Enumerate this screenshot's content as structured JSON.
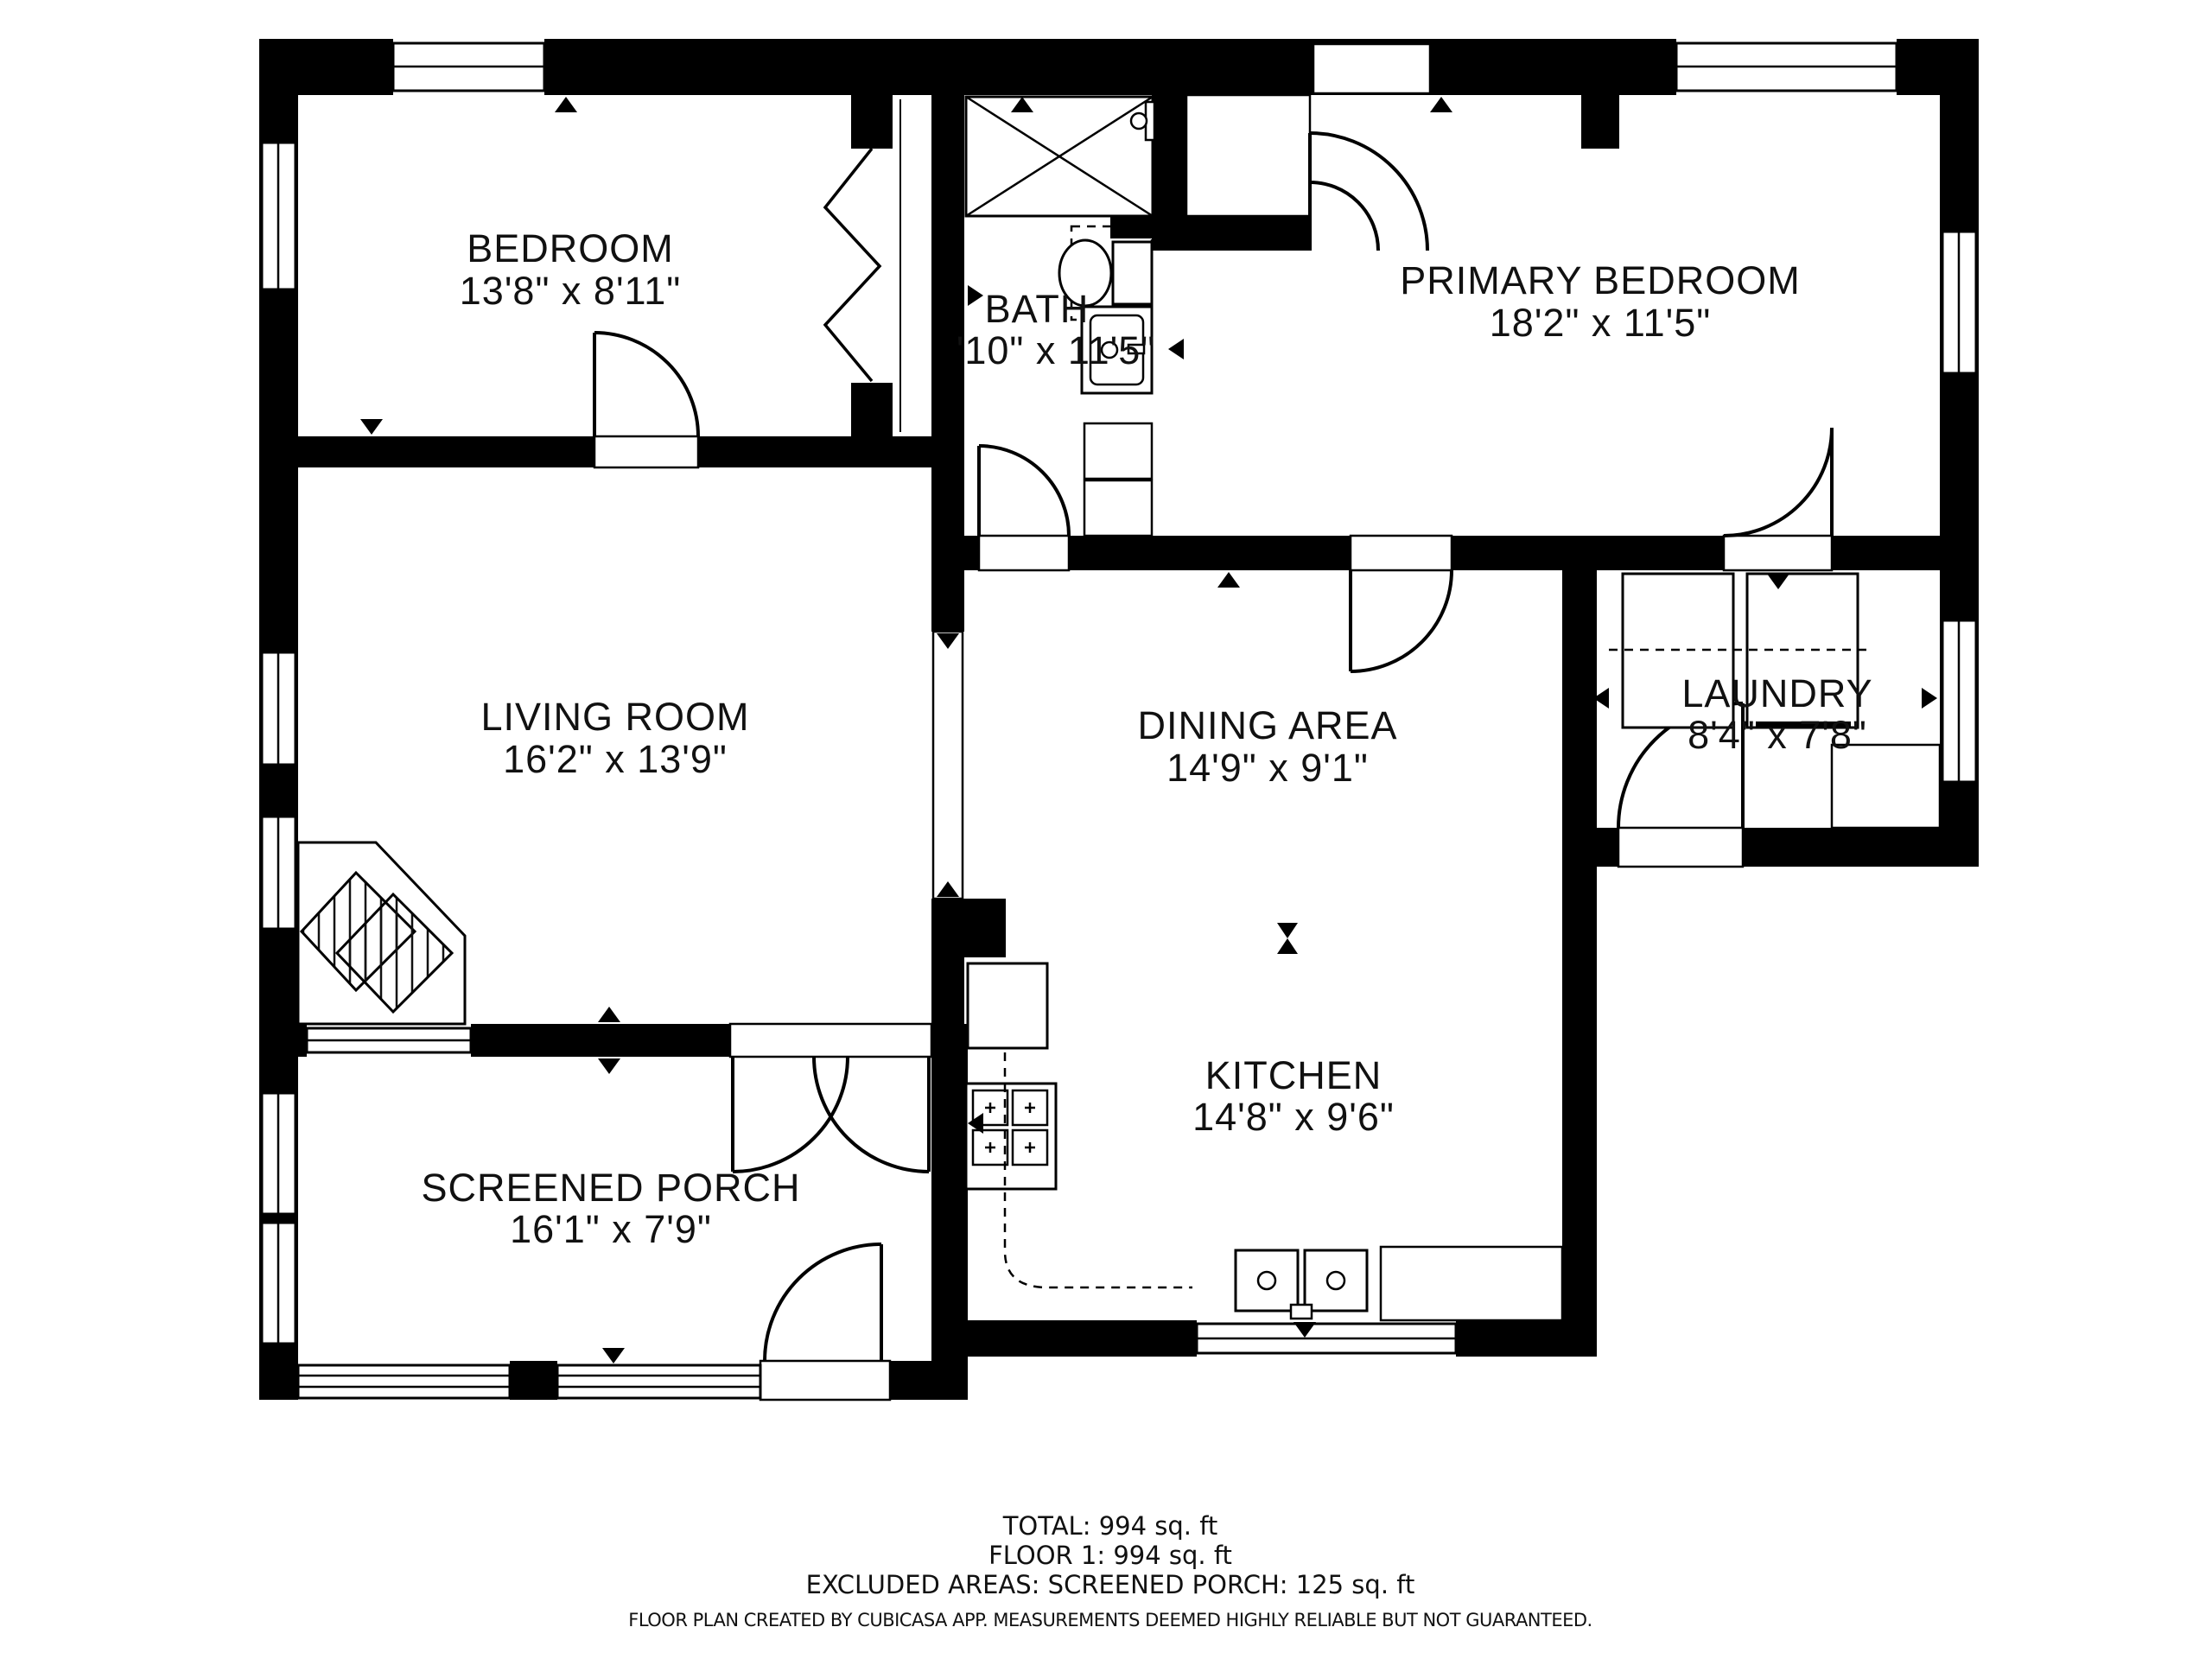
{
  "plan": {
    "wall_color": "#000000",
    "background": "#ffffff",
    "rooms": [
      {
        "id": "bedroom",
        "name": "BEDROOM",
        "dims": "13'8\" x 8'11\""
      },
      {
        "id": "bath",
        "name": "BATH",
        "dims": "'10\" x 11'5\""
      },
      {
        "id": "primary-bedroom",
        "name": "PRIMARY BEDROOM",
        "dims": "18'2\" x 11'5\""
      },
      {
        "id": "living-room",
        "name": "LIVING ROOM",
        "dims": "16'2\" x 13'9\""
      },
      {
        "id": "dining-area",
        "name": "DINING AREA",
        "dims": "14'9\" x 9'1\""
      },
      {
        "id": "laundry",
        "name": "LAUNDRY",
        "dims": "8'4\" x 7'8\""
      },
      {
        "id": "kitchen",
        "name": "KITCHEN",
        "dims": "14'8\" x 9'6\""
      },
      {
        "id": "screened-porch",
        "name": "SCREENED PORCH",
        "dims": "16'1\" x 7'9\""
      }
    ],
    "summary": {
      "total": "TOTAL: 994 sq. ft",
      "floor": "FLOOR 1: 994 sq. ft",
      "excluded": "EXCLUDED AREAS: SCREENED PORCH: 125 sq. ft"
    },
    "disclaimer": "FLOOR PLAN CREATED BY CUBICASA APP. MEASUREMENTS DEEMED HIGHLY RELIABLE BUT NOT GUARANTEED."
  }
}
